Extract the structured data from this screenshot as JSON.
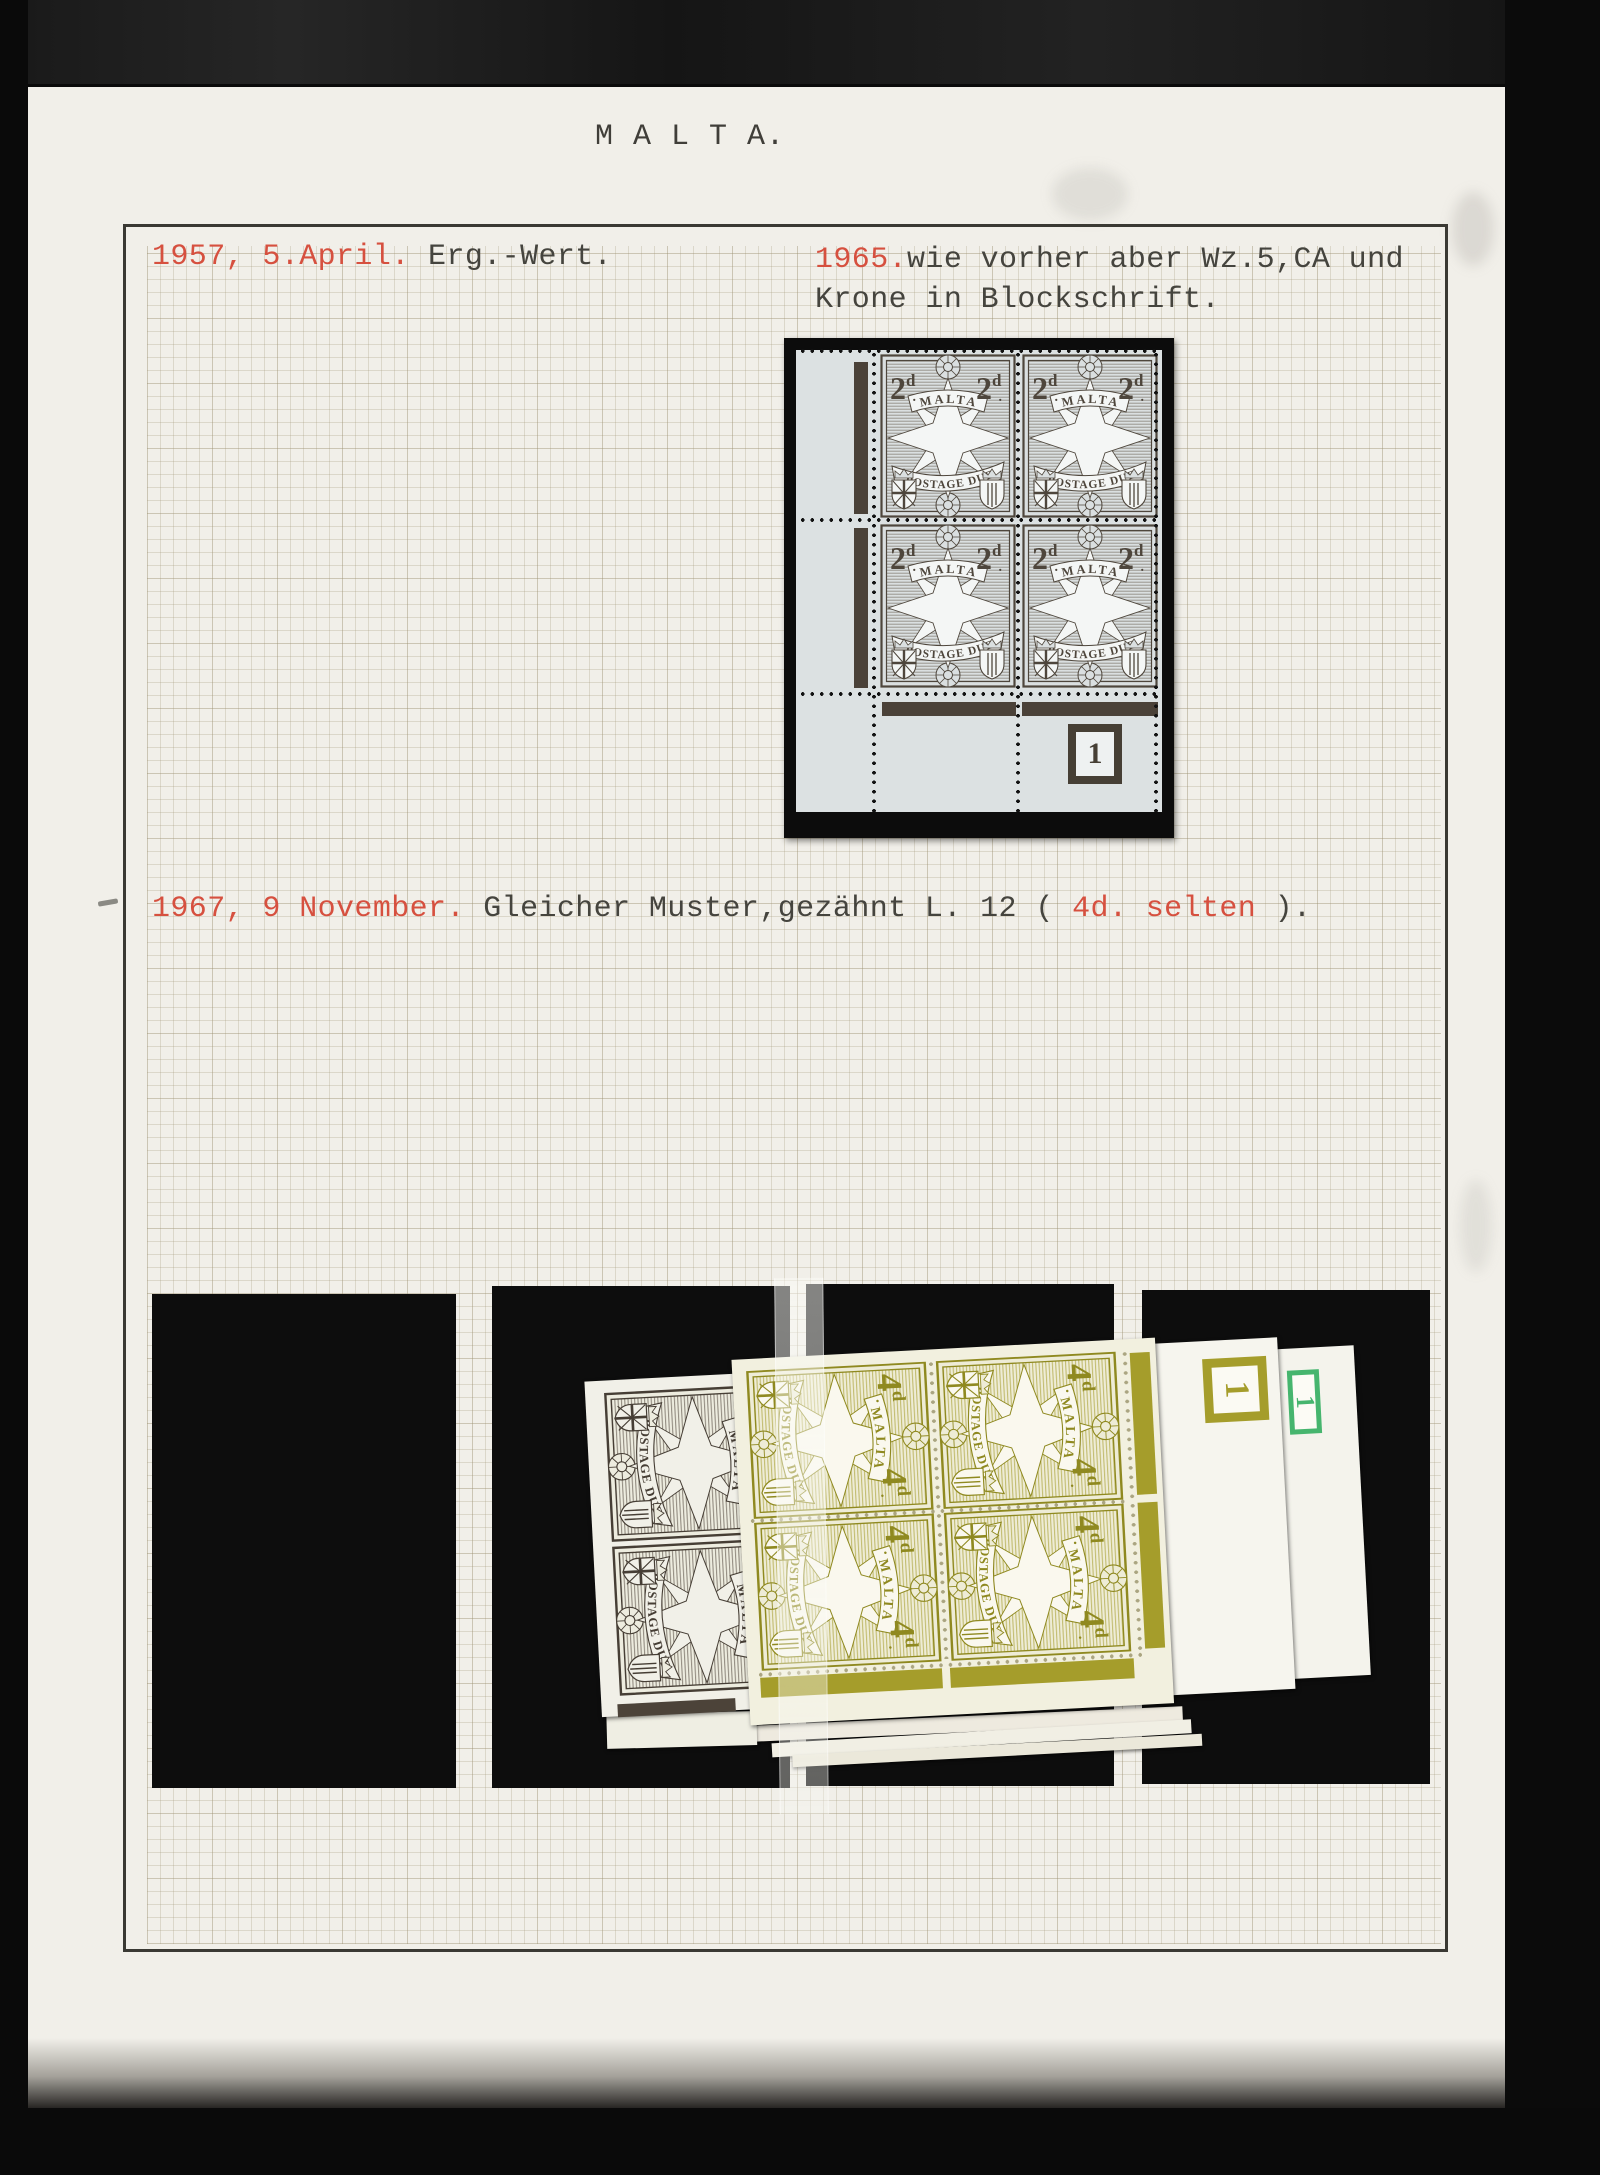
{
  "page": {
    "title": "M A L T A."
  },
  "notes": {
    "n1957": {
      "date_red": "1957, 5.April.",
      "text": " Erg.-Wert."
    },
    "n1965": {
      "year_red": "1965.",
      "line1": "wie vorher aber Wz.5,CA und",
      "line2": "Krone in Blockschrift."
    },
    "n1967": {
      "date_red": "1967, 9 November.",
      "text_mid": " Gleicher Muster,gezähnt L. 12 ( ",
      "value_red": "4d. selten",
      "text_end": " )."
    }
  },
  "stamps": {
    "country": "MALTA",
    "inscription": "POSTAGE DUE",
    "top_block": {
      "denomination": "2d",
      "plate_number": "1",
      "ink": "#6e665a",
      "ink_dark": "#4e463c",
      "paper": "#dadfe0",
      "star": "#f4f6f5",
      "sheet": "#dce1e2",
      "selvedge_bar": "#4a4138"
    },
    "pile_olive": {
      "denomination": "4d",
      "plate_number": "1",
      "ink": "#a69e2f",
      "ink_dark": "#8f8920",
      "paper": "#eeecd6",
      "star": "#faf8ee",
      "sheet": "#f2f0df",
      "plate_box_color": "#a59d2b"
    },
    "pile_grey": {
      "ink": "#5a5046",
      "ink_dark": "#463e35",
      "paper": "#edecdf",
      "star": "#f1f0e8"
    },
    "pile_green_plate": {
      "plate_number": "1",
      "color": "#46b56e"
    }
  },
  "colors": {
    "red": "#d6503f",
    "text_dark": "#45443e",
    "page_paper": "#f1efe9",
    "mount_black": "#0c0c0c"
  }
}
